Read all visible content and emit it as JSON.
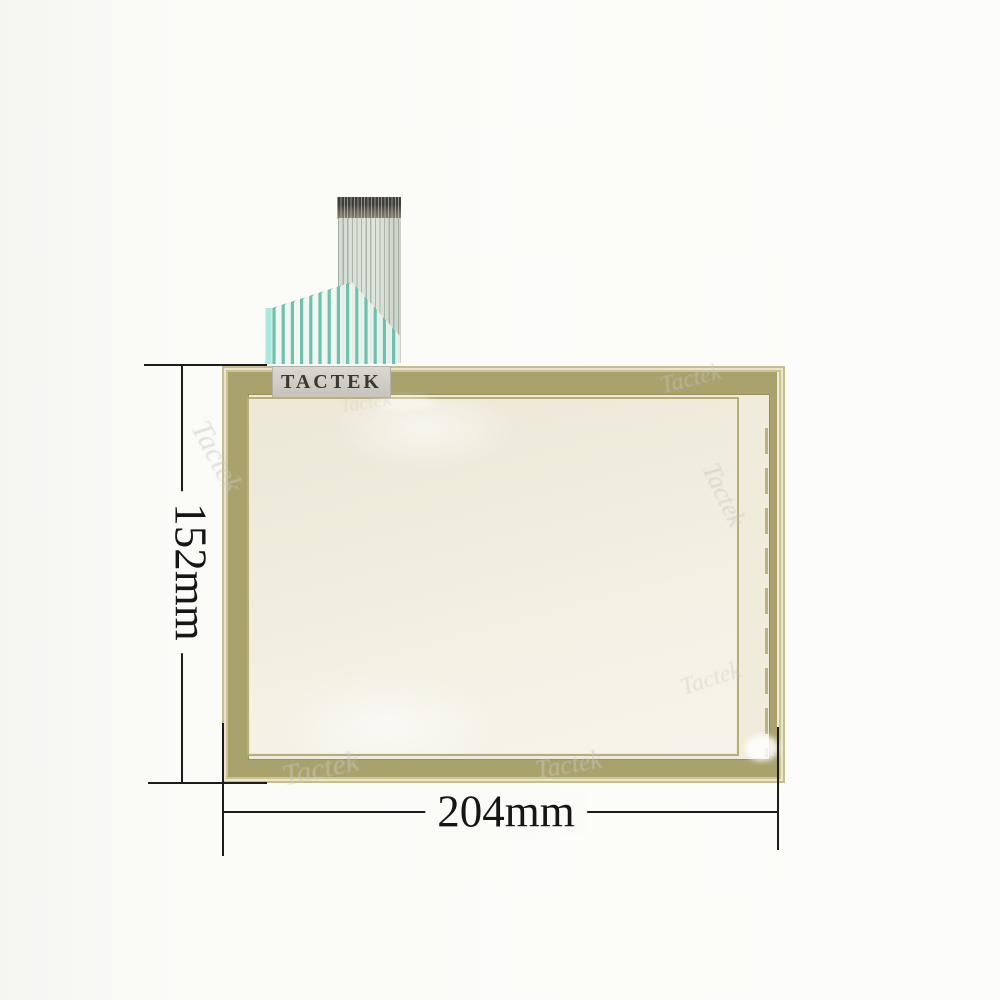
{
  "product": {
    "brand_label": "TACTEK",
    "height_label": "152mm",
    "width_label": "204mm",
    "watermark": "Tactek"
  },
  "colors": {
    "frame_khaki": "#aaa26d",
    "frame_light_edge": "#cdc492",
    "frame_inner_line": "#b7ad76",
    "glass_cream": "#f2efe2",
    "ribbon_teal": "#6fc0ae",
    "ribbon_cyan": "#ade8e0",
    "ribbon_backdrop": "#edf5f0",
    "cable_body": "#dde4d9",
    "connector_dark": "#4a4842",
    "dimension_line": "#1c1c1c",
    "label_bg": "#d0cdc4",
    "label_text": "#3b3833"
  },
  "ribbon": {
    "trace_count": 14
  }
}
